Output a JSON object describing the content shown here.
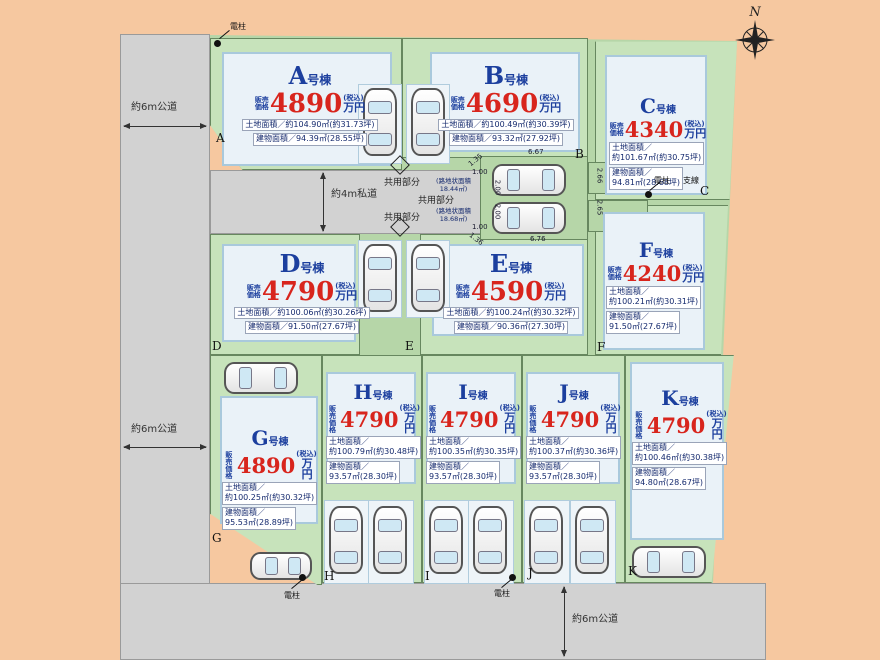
{
  "compass": {
    "north_label": "N"
  },
  "roads": {
    "left_top": "約6m公道",
    "left_bottom": "約6m公道",
    "middle_private": "約4m私道",
    "bottom": "約6m公道"
  },
  "labels": {
    "unit_suffix": "号棟",
    "price_prefix_top": "販売",
    "price_prefix_bottom": "価格",
    "price_unit": "万円",
    "tax_note": "(税込)",
    "shared_area": "共用部分",
    "utility_pole": "電柱",
    "support_wire": "支線",
    "alley_note_1": "(路地状面積\n18.44㎡)",
    "alley_note_2": "(路地状面積\n18.68㎡)"
  },
  "dimensions": {
    "a": "6.67",
    "b": "2.66",
    "c": "2.65",
    "d": "6.76",
    "e": "1.35",
    "f": "1.00",
    "g": "2.00",
    "h": "2.00",
    "i": "1.00",
    "j": "1.36"
  },
  "boundary_letters": [
    "A",
    "B",
    "C",
    "D",
    "E",
    "F",
    "G",
    "H",
    "I",
    "J",
    "K"
  ],
  "lots": [
    {
      "name": "A",
      "price": "4890",
      "land": "土地面積／約104.90㎡(約31.73坪)",
      "building": "建物面積／94.39㎡(28.55坪)"
    },
    {
      "name": "B",
      "price": "4690",
      "land": "土地面積／約100.49㎡(約30.39坪)",
      "building": "建物面積／93.32㎡(27.92坪)"
    },
    {
      "name": "C",
      "price": "4340",
      "land": "土地面積／\n約101.67㎡(約30.75坪)",
      "building": "建物面積／\n94.81㎡(28.68坪)"
    },
    {
      "name": "D",
      "price": "4790",
      "land": "土地面積／約100.06㎡(約30.26坪)",
      "building": "建物面積／91.50㎡(27.67坪)"
    },
    {
      "name": "E",
      "price": "4590",
      "land": "土地面積／約100.24㎡(約30.32坪)",
      "building": "建物面積／90.36㎡(27.30坪)"
    },
    {
      "name": "F",
      "price": "4240",
      "land": "土地面積／\n約100.21㎡(約30.31坪)",
      "building": "建物面積／\n91.50㎡(27.67坪)"
    },
    {
      "name": "G",
      "price": "4890",
      "land": "土地面積／\n約100.25㎡(約30.32坪)",
      "building": "建物面積／\n95.53㎡(28.89坪)"
    },
    {
      "name": "H",
      "price": "4790",
      "land": "土地面積／\n約100.79㎡(約30.48坪)",
      "building": "建物面積／\n93.57㎡(28.30坪)"
    },
    {
      "name": "I",
      "price": "4790",
      "land": "土地面積／\n約100.35㎡(約30.35坪)",
      "building": "建物面積／\n93.57㎡(28.30坪)"
    },
    {
      "name": "J",
      "price": "4790",
      "land": "土地面積／\n約100.37㎡(約30.36坪)",
      "building": "建物面積／\n93.57㎡(28.30坪)"
    },
    {
      "name": "K",
      "price": "4790",
      "land": "土地面積／\n約100.46㎡(約30.38坪)",
      "building": "建物面積／\n94.80㎡(28.67坪)"
    }
  ]
}
